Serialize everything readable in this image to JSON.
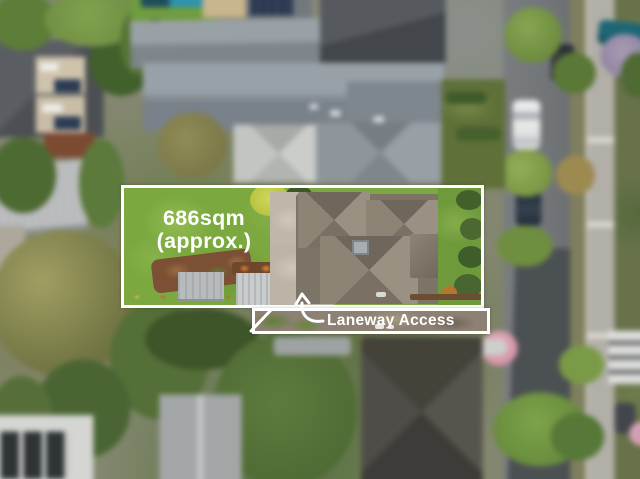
{
  "annotations": {
    "area_line1": "686sqm",
    "area_line2": "(approx.)",
    "laneway_label": "Laneway Access"
  },
  "colors": {
    "annotation_white": "#ffffff",
    "lawn_green": "#7ca93f",
    "laneway_gravel": "#8d8174",
    "road_asphalt": "#717478",
    "road_dark_asphalt": "#4b5053",
    "roof_blue_gray": "#858d95",
    "dark_roof": "#4d5155",
    "property_roof_tile": "#8d8476",
    "concrete": "#beb7aa"
  }
}
